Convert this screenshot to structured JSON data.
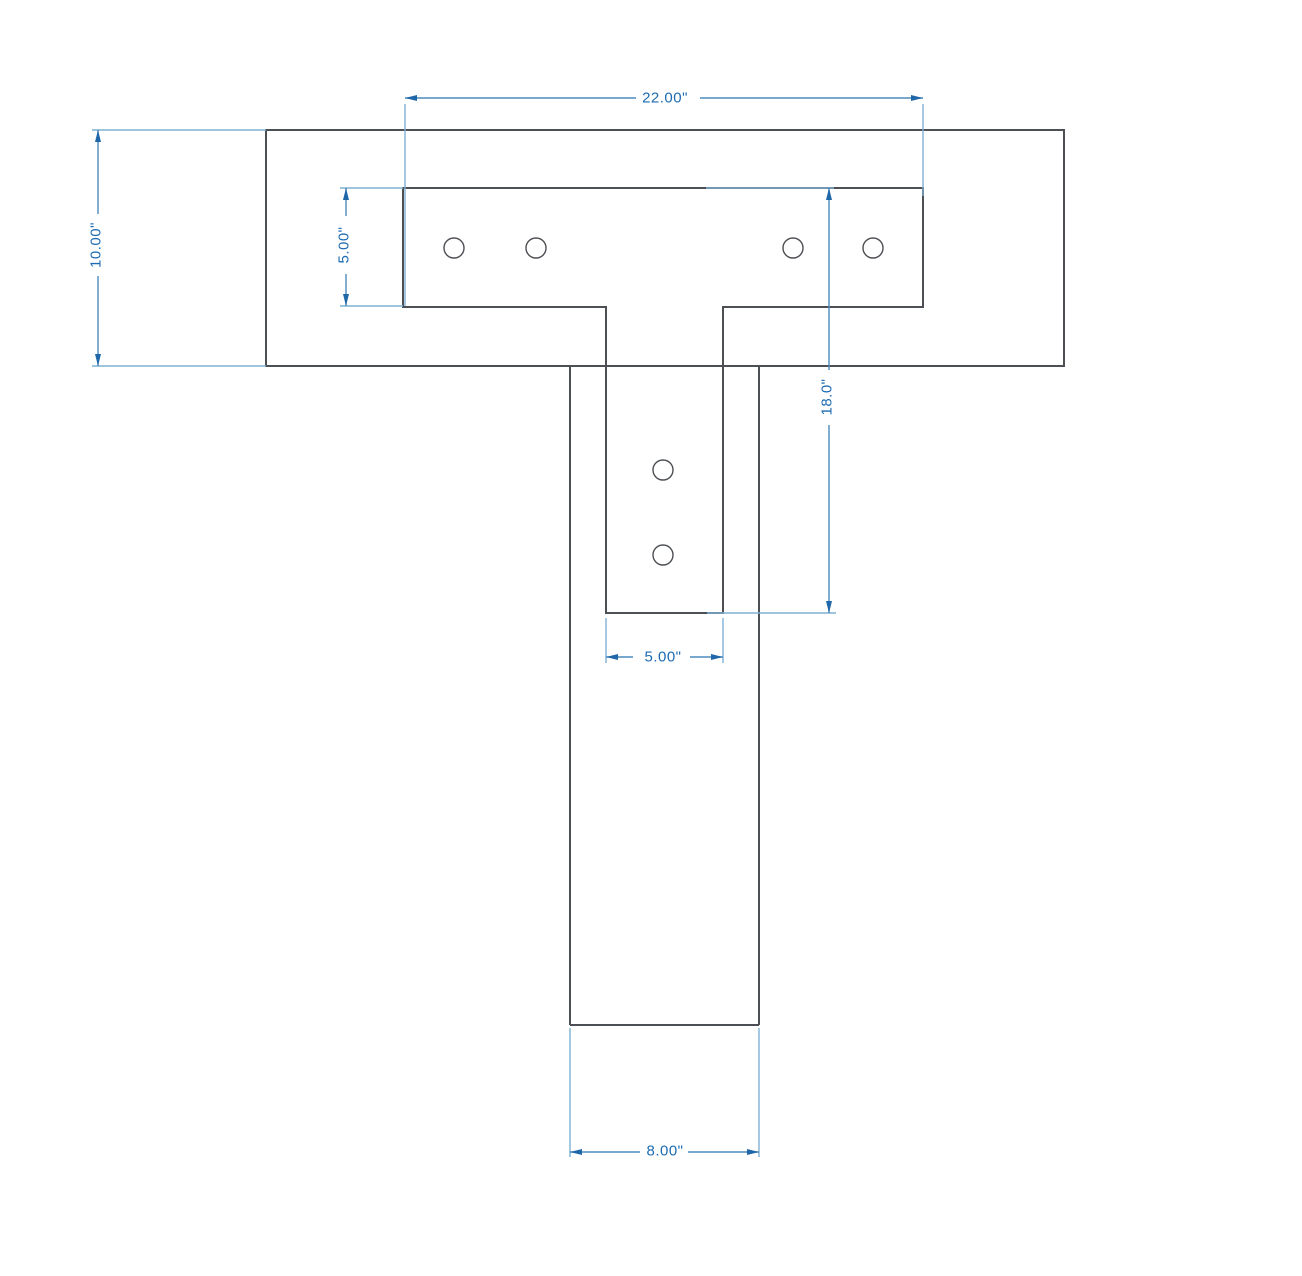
{
  "meta": {
    "title": "T-bracket post-to-beam elevation drawing",
    "background": "#ffffff"
  },
  "canvas": {
    "width": 1302,
    "height": 1276
  },
  "colors": {
    "outline": "#4c4f53",
    "dim_line": "#4d8bbf",
    "dim_ext": "#7fb0d4",
    "dim_arrow": "#1f67a8",
    "dim_text": "#1d6bb1"
  },
  "shapes": {
    "stroke_width": 2,
    "beam": {
      "x": 266,
      "y": 130,
      "width": 798,
      "height": 236
    },
    "post": {
      "segments": [
        [
          570,
          366,
          570,
          1025
        ],
        [
          759,
          366,
          759,
          1025
        ],
        [
          570,
          1025,
          759,
          1025
        ]
      ]
    },
    "bracket": {
      "path": "M403,188 L923,188 L923,307 L723,307 L723,613 L606,613 L606,307 L403,307 Z"
    },
    "holes": {
      "radius": 10,
      "stroke_width": 1.4,
      "centers": [
        [
          454,
          248
        ],
        [
          536,
          248
        ],
        [
          793,
          248
        ],
        [
          873,
          248
        ],
        [
          663,
          470
        ],
        [
          663,
          555
        ]
      ]
    }
  },
  "dimensions": [
    {
      "name": "dim-plate-width",
      "label": "22.00\"",
      "value": "22.00",
      "units": "in",
      "text": {
        "x": 665,
        "y": 98,
        "rotate": 0
      },
      "lines": [
        [
          405,
          98,
          636,
          98
        ],
        [
          700,
          98,
          923,
          98
        ]
      ],
      "extensions": [
        [
          405,
          104,
          405,
          306
        ],
        [
          923,
          104,
          923,
          196
        ]
      ],
      "arrows": [
        {
          "x": 405,
          "y": 98,
          "dir": "left"
        },
        {
          "x": 923,
          "y": 98,
          "dir": "right"
        }
      ]
    },
    {
      "name": "dim-beam-height",
      "label": "10.00\"",
      "value": "10.00",
      "units": "in",
      "text": {
        "x": 96,
        "y": 245,
        "rotate": -90
      },
      "lines": [
        [
          98,
          130,
          98,
          214
        ],
        [
          98,
          276,
          98,
          366
        ]
      ],
      "extensions": [
        [
          92,
          130,
          266,
          130
        ],
        [
          92,
          366,
          266,
          366
        ]
      ],
      "arrows": [
        {
          "x": 98,
          "y": 130,
          "dir": "up"
        },
        {
          "x": 98,
          "y": 366,
          "dir": "down"
        }
      ]
    },
    {
      "name": "dim-plate-arm-height",
      "label": "5.00\"",
      "value": "5.00",
      "units": "in",
      "text": {
        "x": 344,
        "y": 245,
        "rotate": -90
      },
      "lines": [
        [
          346,
          188,
          346,
          216
        ],
        [
          346,
          274,
          346,
          306
        ]
      ],
      "extensions": [
        [
          340,
          188,
          403,
          188
        ],
        [
          340,
          306,
          403,
          306
        ]
      ],
      "arrows": [
        {
          "x": 346,
          "y": 188,
          "dir": "up"
        },
        {
          "x": 346,
          "y": 306,
          "dir": "down"
        }
      ]
    },
    {
      "name": "dim-bracket-height",
      "label": "18.0\"",
      "value": "18.0",
      "units": "in",
      "text": {
        "x": 827,
        "y": 397,
        "rotate": -90
      },
      "lines": [
        [
          829,
          188,
          829,
          370
        ],
        [
          829,
          425,
          829,
          613
        ]
      ],
      "extensions": [
        [
          706,
          188,
          834,
          188
        ],
        [
          707,
          613,
          836,
          613
        ]
      ],
      "arrows": [
        {
          "x": 829,
          "y": 188,
          "dir": "up"
        },
        {
          "x": 829,
          "y": 613,
          "dir": "down"
        }
      ]
    },
    {
      "name": "dim-bracket-leg-width",
      "label": "5.00\"",
      "value": "5.00",
      "units": "in",
      "text": {
        "x": 663,
        "y": 657,
        "rotate": 0
      },
      "lines": [
        [
          606,
          657,
          633,
          657
        ],
        [
          690,
          657,
          723,
          657
        ]
      ],
      "extensions": [
        [
          606,
          618,
          606,
          663
        ],
        [
          723,
          618,
          723,
          663
        ]
      ],
      "arrows": [
        {
          "x": 606,
          "y": 657,
          "dir": "left"
        },
        {
          "x": 723,
          "y": 657,
          "dir": "right"
        }
      ]
    },
    {
      "name": "dim-post-width",
      "label": "8.00\"",
      "value": "8.00",
      "units": "in",
      "text": {
        "x": 665,
        "y": 1151,
        "rotate": 0
      },
      "lines": [
        [
          570,
          1152,
          640,
          1152
        ],
        [
          688,
          1152,
          759,
          1152
        ]
      ],
      "extensions": [
        [
          570,
          1028,
          570,
          1157
        ],
        [
          759,
          1028,
          759,
          1157
        ]
      ],
      "arrows": [
        {
          "x": 570,
          "y": 1152,
          "dir": "left"
        },
        {
          "x": 759,
          "y": 1152,
          "dir": "right"
        }
      ]
    }
  ]
}
